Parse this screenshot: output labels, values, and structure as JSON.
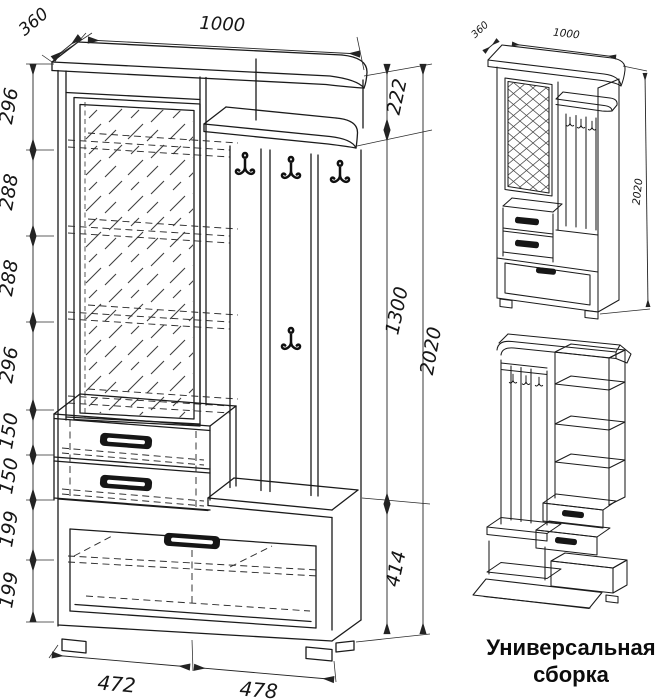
{
  "caption": {
    "line1": "Универсальная",
    "line2": "сборка"
  },
  "main_view": {
    "width_top": "1000",
    "depth_top": "360",
    "left_heights": [
      "296",
      "288",
      "288",
      "296",
      "150",
      "150",
      "199",
      "199"
    ],
    "right_heights": [
      "222",
      "1300",
      "414"
    ],
    "total_height": "2020",
    "bottom_widths": [
      "472",
      "478"
    ]
  },
  "iso_view": {
    "depth": "360",
    "width": "1000",
    "height": "2020"
  },
  "colors": {
    "line": "#1b1b1b",
    "background": "#ffffff"
  }
}
